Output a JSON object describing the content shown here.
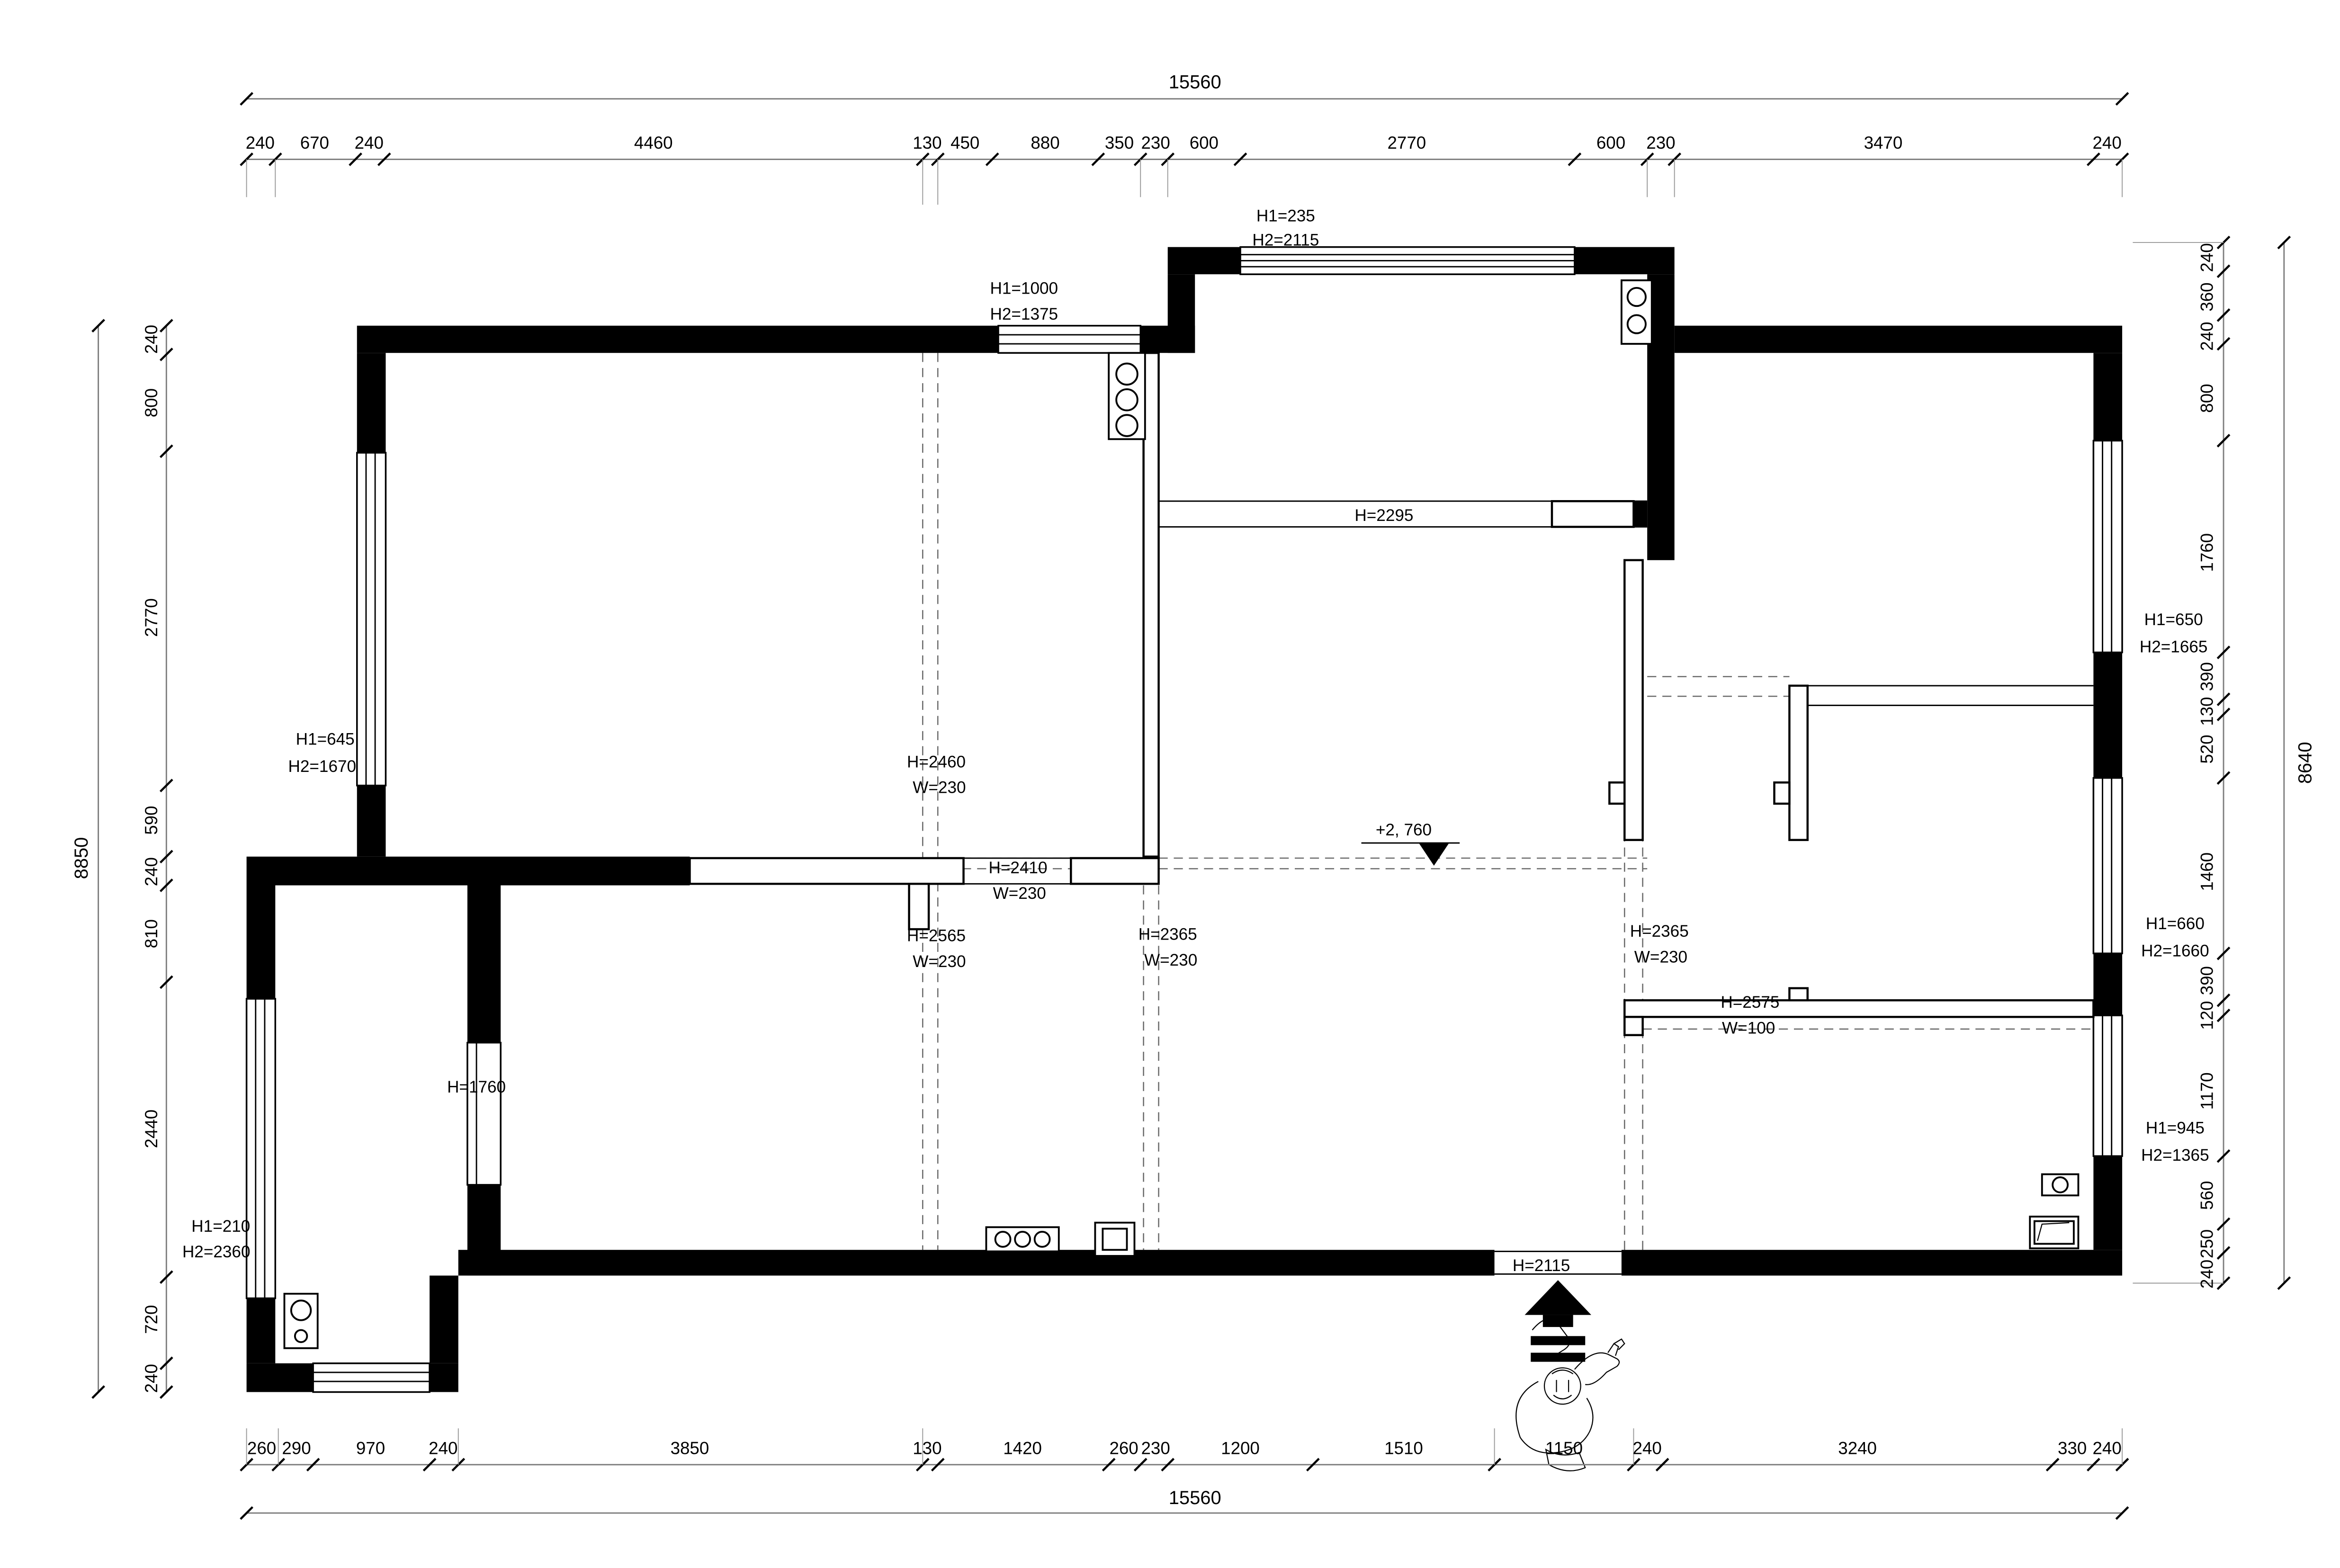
{
  "drawing": {
    "type": "architectural floor plan",
    "units": "mm"
  },
  "overall": {
    "top": "15560",
    "bottom": "15560",
    "left": "8850",
    "right": "8640"
  },
  "dims": {
    "top": [
      "240",
      "670",
      "240",
      "4460",
      "130",
      "450",
      "880",
      "350",
      "230",
      "600",
      "2770",
      "600",
      "230",
      "3470",
      "240"
    ],
    "bottom": [
      "260",
      "290",
      "970",
      "240",
      "3850",
      "130",
      "1420",
      "260",
      "230",
      "1200",
      "1510",
      "1150",
      "240",
      "3240",
      "330",
      "240"
    ],
    "left": [
      "240",
      "800",
      "2770",
      "590",
      "240",
      "810",
      "2440",
      "720",
      "240"
    ],
    "right": [
      "240",
      "360",
      "240",
      "800",
      "1760",
      "390",
      "130",
      "520",
      "1460",
      "390",
      "120",
      "1170",
      "560",
      "250",
      "240"
    ]
  },
  "ann": {
    "bay_h1": "H1=235",
    "bay_h2": "H2=2115",
    "tlwin_h1": "H1=1000",
    "tlwin_h2": "H2=1375",
    "beam": "H=2295",
    "lwin_h1": "H1=645",
    "lwin_h2": "H2=1670",
    "d2460_h": "H=2460",
    "d2460_w": "W=230",
    "d2410_h": "H=2410",
    "d2410_w": "W=230",
    "d2565_h": "H=2565",
    "d2565_w": "W=230",
    "d2365a_h": "H=2365",
    "d2365a_w": "W=230",
    "d2365b_h": "H=2365",
    "d2365b_w": "W=230",
    "d2575_h": "H=2575",
    "d2575_w": "W=100",
    "level": "+2, 760",
    "entry": "H=2115",
    "d1760": "H=1760",
    "blwin_h1": "H1=210",
    "blwin_h2": "H2=2360",
    "rwin1_h1": "H1=650",
    "rwin1_h2": "H2=1665",
    "rwin2_h1": "H1=660",
    "rwin2_h2": "H2=1660",
    "rwin3_h1": "H1=945",
    "rwin3_h2": "H2=1365"
  }
}
